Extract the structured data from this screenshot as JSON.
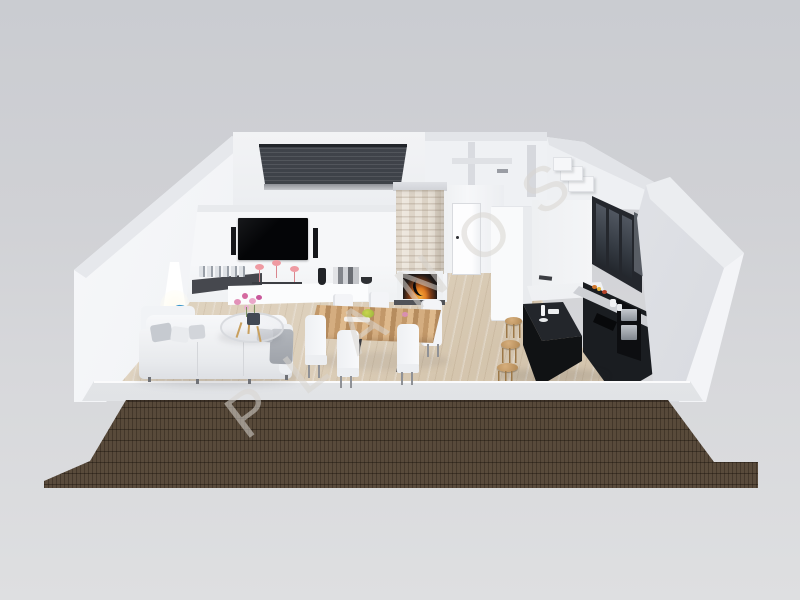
{
  "image": {
    "kind": "3d-floor-plan-render",
    "watermark": {
      "text": "PLANOS"
    },
    "palette": {
      "background_gray": "#d2d3d7",
      "wall_white": "#f4f5f7",
      "wall_top_gray": "#e3e5e9",
      "floor_wood": "#d8c9b2",
      "terrace_tile_brown": "#4e4136",
      "kitchen_cabinet_black": "#1a1d21",
      "roller_shutter_gray": "#383c42",
      "sofa_light_gray": "#eef0f2",
      "stool_wood": "#c49b68",
      "dining_table_wood": "#c9a272",
      "fire_glow_orange": "#e07b22",
      "flamingo_pink": "#ef9aa2",
      "lamp_accent_blue": "#2a86bd",
      "orchid_pink": "#d4699f"
    },
    "objects": [
      "living-room",
      "tv-wall",
      "fireplace",
      "hallway-door",
      "bathroom-rooms",
      "kitchen",
      "kitchen-island",
      "dining-set",
      "sofa",
      "floor-lamp",
      "coffee-table",
      "terrace"
    ]
  }
}
